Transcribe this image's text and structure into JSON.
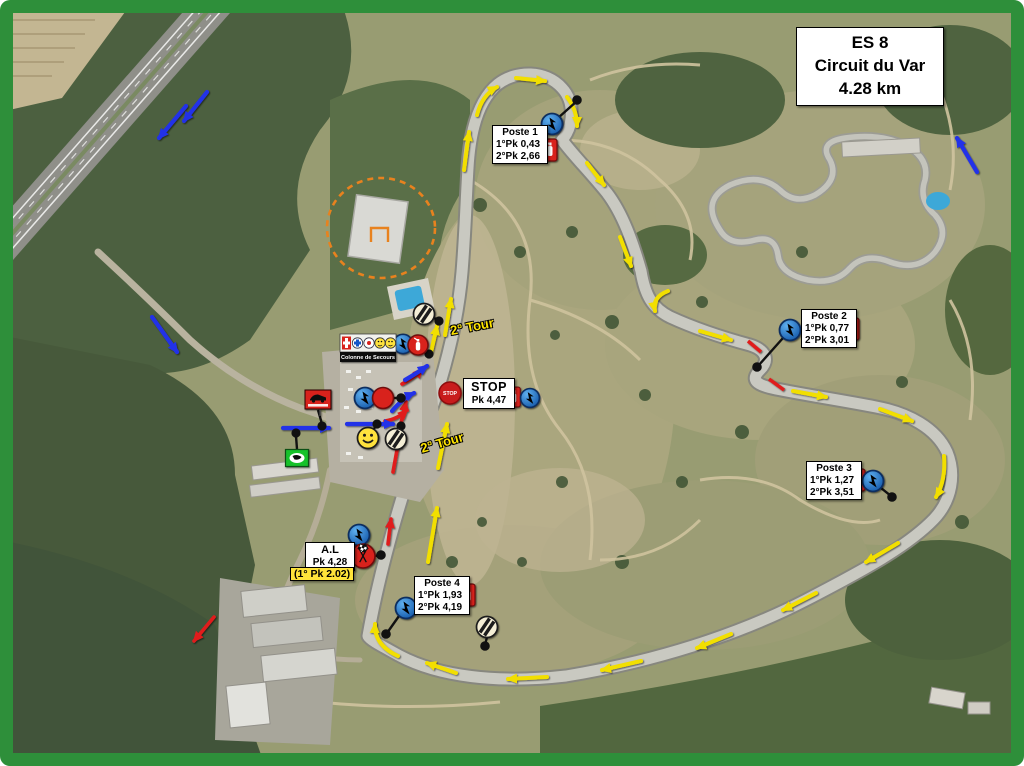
{
  "frame": {
    "edge_text": "es",
    "color": "#2e8f3a"
  },
  "title_box": {
    "line1": "ES 8",
    "line2": "Circuit du Var",
    "line3": "4.28 km"
  },
  "postes": [
    {
      "name": "Poste 1",
      "pk1": "1°Pk 0,43",
      "pk2": "2°Pk 2,66"
    },
    {
      "name": "Poste 2",
      "pk1": "1°Pk 0,77",
      "pk2": "2°Pk 3,01"
    },
    {
      "name": "Poste 3",
      "pk1": "1°Pk 1,27",
      "pk2": "2°Pk 3,51"
    },
    {
      "name": "Poste 4",
      "pk1": "1°Pk 1,93",
      "pk2": "2°Pk 4,19"
    }
  ],
  "stop_box": {
    "sign": "STOP",
    "title": "STOP",
    "pk": "Pk 4,47"
  },
  "al_box": {
    "title": "A.L",
    "pk": "Pk 4,28",
    "note": "(1° Pk 2.02)"
  },
  "tour_labels": {
    "first": "2° Tour",
    "second": "2° Tour"
  },
  "colonne_label": "Colonne de Secours",
  "icons": {
    "lightning": "radio-point",
    "extinguisher": "fire-extinguisher",
    "smiley": "marshal-point",
    "striped_circle": "timing-point",
    "checkered_flags": "flying-finish",
    "stop_sign": "stop-control",
    "red_car_sign": "safety-car-sign",
    "green_car_sign": "race-direction-sign"
  },
  "colors": {
    "frame_green": "#2e8f3a",
    "arrow_yellow": "#f2df00",
    "arrow_blue": "#2330e8",
    "arrow_red": "#e01b1b",
    "note_yellow": "#ffe43a",
    "sign_red": "#d8201c",
    "sign_green": "#17c22b",
    "radio_blue": "#1f6fd0"
  }
}
